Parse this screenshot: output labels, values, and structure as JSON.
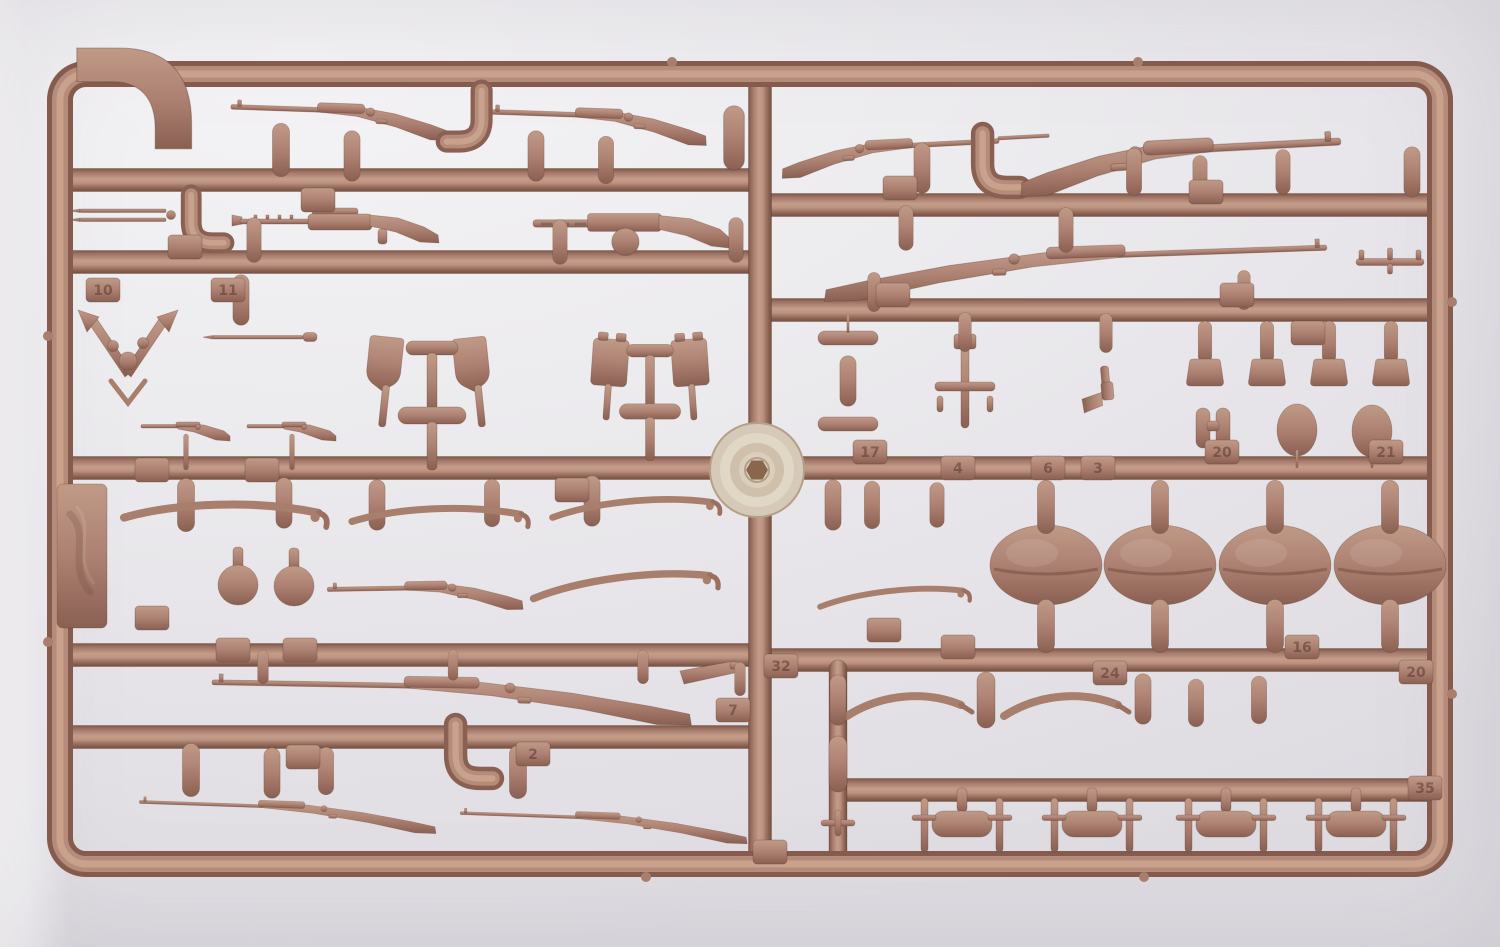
{
  "meta": {
    "alt": "Photograph of a tan plastic model kit sprue (parts tree) holding miniature rifles, machine guns, sabers, shovels, helmets, pouches and accessories, with faint embossed part-number tabs"
  },
  "photo": {
    "background": {
      "base": "#ecebee",
      "light": "#f8f7f8",
      "shade": "#dedce1"
    },
    "plastic": {
      "mid": "#ad8172",
      "light": "#c9a28d",
      "dark": "#7e5849",
      "edge": "#8a6052",
      "tab_text": "#4f342a"
    },
    "disc_colors": {
      "outer": "#d6c9b8",
      "mid": "#e1d7c6",
      "inner": "#cec0aa",
      "hub": "#8a674c"
    }
  },
  "sprue": {
    "frame": {
      "x": 60,
      "y": 74,
      "w": 1380,
      "h": 790,
      "radius": 26
    },
    "runners_h": [
      {
        "y": 180,
        "x1": 60,
        "x2": 762
      },
      {
        "y": 262,
        "x1": 60,
        "x2": 762
      },
      {
        "y": 468,
        "x1": 60,
        "x2": 1440
      },
      {
        "y": 655,
        "x1": 60,
        "x2": 762
      },
      {
        "y": 737,
        "x1": 60,
        "x2": 762
      },
      {
        "y": 205,
        "x1": 758,
        "x2": 1440
      },
      {
        "y": 310,
        "x1": 758,
        "x2": 1440
      },
      {
        "y": 660,
        "x1": 758,
        "x2": 1440
      },
      {
        "y": 790,
        "x1": 834,
        "x2": 1440
      }
    ],
    "runners_v": [
      {
        "x": 760,
        "y1": 74,
        "y2": 864,
        "w": 23
      },
      {
        "x": 838,
        "y1": 660,
        "y2": 864,
        "w": 18
      }
    ],
    "disc": {
      "x": 757,
      "y": 470
    },
    "nubs": [
      [
        672,
        62
      ],
      [
        1138,
        62
      ],
      [
        646,
        877
      ],
      [
        1144,
        877
      ],
      [
        1452,
        302
      ],
      [
        1452,
        694
      ],
      [
        48,
        336
      ],
      [
        48,
        642
      ]
    ],
    "parts": [
      {
        "t": "hook",
        "x": 158,
        "y": 125,
        "s": 1.4
      },
      {
        "t": "rifle",
        "x": 340,
        "y": 112,
        "r": 2,
        "s": 0.95
      },
      {
        "t": "rifle",
        "x": 598,
        "y": 117,
        "r": 2,
        "s": 0.95
      },
      {
        "t": "jcurve",
        "x": 468,
        "y": 128,
        "s": 0.85,
        "f": 1
      },
      {
        "t": "capsule",
        "x": 281,
        "y": 150,
        "s": 0.95
      },
      {
        "t": "capsule",
        "x": 352,
        "y": 156,
        "s": 0.9
      },
      {
        "t": "capsule",
        "x": 536,
        "y": 156,
        "s": 0.9
      },
      {
        "t": "capsule",
        "x": 606,
        "y": 160,
        "s": 0.85
      },
      {
        "t": "capsule",
        "x": 734,
        "y": 138,
        "s": 1.15
      },
      {
        "t": "bay2",
        "x": 128,
        "y": 216
      },
      {
        "t": "jcurve",
        "x": 204,
        "y": 230,
        "s": 0.8
      },
      {
        "t": "mg",
        "x": 352,
        "y": 222
      },
      {
        "t": "mg2",
        "x": 638,
        "y": 224,
        "s": 1.05
      },
      {
        "t": "capsule",
        "x": 254,
        "y": 240,
        "s": 0.8
      },
      {
        "t": "capsule",
        "x": 560,
        "y": 242,
        "s": 0.8
      },
      {
        "t": "capsule",
        "x": 736,
        "y": 240,
        "s": 0.8
      },
      {
        "t": "vpart",
        "x": 128,
        "y": 345
      },
      {
        "t": "capsule",
        "x": 241,
        "y": 300,
        "s": 0.9
      },
      {
        "t": "bay1",
        "x": 258,
        "y": 337
      },
      {
        "t": "shovelcluster",
        "x": 432,
        "y": 405
      },
      {
        "t": "tincluster",
        "x": 650,
        "y": 402,
        "s": 0.9
      },
      {
        "t": "smallrifle",
        "x": 186,
        "y": 427
      },
      {
        "t": "stem",
        "x": 186,
        "y": 452,
        "s": 0.6
      },
      {
        "t": "smallrifle",
        "x": 292,
        "y": 427
      },
      {
        "t": "stem",
        "x": 292,
        "y": 452,
        "s": 0.6
      },
      {
        "t": "capsule",
        "x": 186,
        "y": 505,
        "s": 0.95
      },
      {
        "t": "capsule",
        "x": 284,
        "y": 503,
        "s": 0.9
      },
      {
        "t": "capsule",
        "x": 377,
        "y": 505,
        "s": 0.9
      },
      {
        "t": "capsule",
        "x": 492,
        "y": 503,
        "s": 0.85
      },
      {
        "t": "capsule",
        "x": 592,
        "y": 501,
        "s": 0.9
      },
      {
        "t": "saber",
        "x": 222,
        "y": 513,
        "r": 2,
        "s": 1.15
      },
      {
        "t": "saber",
        "x": 437,
        "y": 516,
        "r": 1
      },
      {
        "t": "saber",
        "x": 633,
        "y": 508,
        "r": -2,
        "s": 0.95
      },
      {
        "t": "grenade",
        "x": 238,
        "y": 585
      },
      {
        "t": "grenade",
        "x": 294,
        "y": 586
      },
      {
        "t": "rifle",
        "x": 425,
        "y": 589,
        "r": -1,
        "s": 0.85
      },
      {
        "t": "saber",
        "x": 622,
        "y": 585,
        "r": -4,
        "s": 1.05
      },
      {
        "t": "longrifle",
        "x": 452,
        "y": 688,
        "r": 1
      },
      {
        "t": "capsule",
        "x": 263,
        "y": 667,
        "s": 0.6
      },
      {
        "t": "capsule",
        "x": 453,
        "y": 665,
        "s": 0.55
      },
      {
        "t": "capsule",
        "x": 643,
        "y": 667,
        "s": 0.6
      },
      {
        "t": "wedge",
        "x": 708,
        "y": 677
      },
      {
        "t": "capsule",
        "x": 740,
        "y": 679,
        "s": 0.6
      },
      {
        "t": "capsule",
        "x": 191,
        "y": 770,
        "s": 0.95
      },
      {
        "t": "capsule",
        "x": 272,
        "y": 773,
        "s": 0.9
      },
      {
        "t": "capsule",
        "x": 326,
        "y": 771,
        "s": 0.85
      },
      {
        "t": "jcurve",
        "x": 470,
        "y": 764,
        "s": 0.9
      },
      {
        "t": "capsule",
        "x": 518,
        "y": 772,
        "s": 0.95
      },
      {
        "t": "longrifle",
        "x": 288,
        "y": 808,
        "r": 2,
        "s": 0.62
      },
      {
        "t": "longrifle",
        "x": 604,
        "y": 819,
        "r": 2,
        "s": 0.6
      },
      {
        "t": "riflebay",
        "x": 890,
        "y": 148,
        "r": -3,
        "s": 0.95,
        "f": 1
      },
      {
        "t": "jcurve",
        "x": 997,
        "y": 173,
        "s": 0.9
      },
      {
        "t": "rifle",
        "x": 1180,
        "y": 152,
        "r": -3,
        "s": 1.4,
        "f": 1
      },
      {
        "t": "capsule",
        "x": 922,
        "y": 168,
        "s": 0.9
      },
      {
        "t": "capsule",
        "x": 1134,
        "y": 172,
        "s": 0.85
      },
      {
        "t": "capsule",
        "x": 1200,
        "y": 178,
        "s": 0.8
      },
      {
        "t": "capsule",
        "x": 1283,
        "y": 172,
        "s": 0.8
      },
      {
        "t": "capsule",
        "x": 1412,
        "y": 172,
        "s": 0.9
      },
      {
        "t": "longrifle",
        "x": 1075,
        "y": 258,
        "r": -2,
        "s": 1.05,
        "f": 1
      },
      {
        "t": "capsule",
        "x": 906,
        "y": 228,
        "s": 0.8
      },
      {
        "t": "capsule",
        "x": 1066,
        "y": 230,
        "s": 0.8
      },
      {
        "t": "capsule",
        "x": 874,
        "y": 292,
        "s": 0.7
      },
      {
        "t": "capsule",
        "x": 1244,
        "y": 290,
        "s": 0.7
      },
      {
        "t": "tpart",
        "x": 1390,
        "y": 262
      },
      {
        "t": "mag",
        "x": 848,
        "y": 338
      },
      {
        "t": "mag",
        "x": 848,
        "y": 424
      },
      {
        "t": "capsule",
        "x": 848,
        "y": 381,
        "s": 0.9
      },
      {
        "t": "stem",
        "x": 848,
        "y": 324,
        "s": 0.3
      },
      {
        "t": "crosspart",
        "x": 965,
        "y": 388
      },
      {
        "t": "capsule",
        "x": 965,
        "y": 332,
        "s": 0.7
      },
      {
        "t": "pistol",
        "x": 1106,
        "y": 386,
        "r": 85
      },
      {
        "t": "capsule",
        "x": 1106,
        "y": 333,
        "s": 0.7
      },
      {
        "t": "capsule",
        "x": 1205,
        "y": 342,
        "s": 0.75
      },
      {
        "t": "pouch",
        "x": 1205,
        "y": 372
      },
      {
        "t": "capsule",
        "x": 1267,
        "y": 342,
        "s": 0.75
      },
      {
        "t": "pouch",
        "x": 1267,
        "y": 372
      },
      {
        "t": "capsule",
        "x": 1329,
        "y": 342,
        "s": 0.75
      },
      {
        "t": "pouch",
        "x": 1329,
        "y": 372
      },
      {
        "t": "capsule",
        "x": 1391,
        "y": 342,
        "s": 0.75
      },
      {
        "t": "pouch",
        "x": 1391,
        "y": 372
      },
      {
        "t": "capsule",
        "x": 833,
        "y": 505,
        "s": 0.9
      },
      {
        "t": "capsule",
        "x": 872,
        "y": 505,
        "s": 0.85
      },
      {
        "t": "capsule",
        "x": 937,
        "y": 505,
        "s": 0.8
      },
      {
        "t": "binoc",
        "x": 1213,
        "y": 428
      },
      {
        "t": "stem",
        "x": 1213,
        "y": 452,
        "s": 0.3
      },
      {
        "t": "ovalsmall",
        "x": 1297,
        "y": 430
      },
      {
        "t": "stem",
        "x": 1297,
        "y": 459,
        "s": 0.3
      },
      {
        "t": "ovalsmall",
        "x": 1372,
        "y": 431
      },
      {
        "t": "stem",
        "x": 1372,
        "y": 459,
        "s": 0.3
      },
      {
        "t": "helmet",
        "x": 1046,
        "y": 565
      },
      {
        "t": "capsule",
        "x": 1046,
        "y": 507,
        "s": 0.95
      },
      {
        "t": "capsule",
        "x": 1046,
        "y": 626,
        "s": 0.95
      },
      {
        "t": "helmet",
        "x": 1160,
        "y": 565
      },
      {
        "t": "capsule",
        "x": 1160,
        "y": 507,
        "s": 0.95
      },
      {
        "t": "capsule",
        "x": 1160,
        "y": 626,
        "s": 0.95
      },
      {
        "t": "helmet",
        "x": 1275,
        "y": 565
      },
      {
        "t": "capsule",
        "x": 1275,
        "y": 507,
        "s": 0.95
      },
      {
        "t": "capsule",
        "x": 1275,
        "y": 626,
        "s": 0.95
      },
      {
        "t": "helmet",
        "x": 1390,
        "y": 565
      },
      {
        "t": "capsule",
        "x": 1390,
        "y": 507,
        "s": 0.95
      },
      {
        "t": "capsule",
        "x": 1390,
        "y": 626,
        "s": 0.95
      },
      {
        "t": "saber",
        "x": 892,
        "y": 597,
        "r": -3,
        "s": 0.85
      },
      {
        "t": "sabershort",
        "x": 905,
        "y": 706
      },
      {
        "t": "sabershort",
        "x": 1062,
        "y": 706
      },
      {
        "t": "capsule",
        "x": 986,
        "y": 700
      },
      {
        "t": "capsule",
        "x": 1143,
        "y": 699,
        "s": 0.9
      },
      {
        "t": "capsule",
        "x": 1196,
        "y": 703,
        "s": 0.85
      },
      {
        "t": "capsule",
        "x": 1259,
        "y": 700,
        "s": 0.85
      },
      {
        "t": "capsule",
        "x": 838,
        "y": 700,
        "s": 0.9
      },
      {
        "t": "capsule",
        "x": 838,
        "y": 764
      },
      {
        "t": "tinycross",
        "x": 838,
        "y": 823
      },
      {
        "t": "cross",
        "x": 962,
        "y": 824
      },
      {
        "t": "cross",
        "x": 1092,
        "y": 824
      },
      {
        "t": "cross",
        "x": 1226,
        "y": 824
      },
      {
        "t": "cross",
        "x": 1356,
        "y": 824
      },
      {
        "t": "plate",
        "x": 82,
        "y": 556
      }
    ],
    "tags": [
      {
        "label": "",
        "x": 318,
        "y": 200
      },
      {
        "label": "",
        "x": 185,
        "y": 247
      },
      {
        "label": "10",
        "x": 103,
        "y": 290
      },
      {
        "label": "11",
        "x": 228,
        "y": 290
      },
      {
        "label": "",
        "x": 152,
        "y": 470
      },
      {
        "label": "",
        "x": 262,
        "y": 470
      },
      {
        "label": "",
        "x": 572,
        "y": 490
      },
      {
        "label": "",
        "x": 152,
        "y": 618
      },
      {
        "label": "",
        "x": 233,
        "y": 650
      },
      {
        "label": "",
        "x": 300,
        "y": 650
      },
      {
        "label": "7",
        "x": 733,
        "y": 710
      },
      {
        "label": "2",
        "x": 533,
        "y": 754
      },
      {
        "label": "",
        "x": 303,
        "y": 757
      },
      {
        "label": "",
        "x": 900,
        "y": 188
      },
      {
        "label": "",
        "x": 1206,
        "y": 192
      },
      {
        "label": "",
        "x": 893,
        "y": 295
      },
      {
        "label": "",
        "x": 1237,
        "y": 295
      },
      {
        "label": "",
        "x": 1308,
        "y": 333
      },
      {
        "label": "17",
        "x": 870,
        "y": 452
      },
      {
        "label": "4",
        "x": 958,
        "y": 468
      },
      {
        "label": "6",
        "x": 1048,
        "y": 468
      },
      {
        "label": "3",
        "x": 1098,
        "y": 468
      },
      {
        "label": "20",
        "x": 1222,
        "y": 452
      },
      {
        "label": "21",
        "x": 1386,
        "y": 452
      },
      {
        "label": "",
        "x": 884,
        "y": 630
      },
      {
        "label": "32",
        "x": 781,
        "y": 666
      },
      {
        "label": "",
        "x": 958,
        "y": 647
      },
      {
        "label": "24",
        "x": 1110,
        "y": 673
      },
      {
        "label": "16",
        "x": 1302,
        "y": 647
      },
      {
        "label": "20",
        "x": 1416,
        "y": 672
      },
      {
        "label": "35",
        "x": 1425,
        "y": 788
      },
      {
        "label": "",
        "x": 770,
        "y": 852
      }
    ]
  }
}
